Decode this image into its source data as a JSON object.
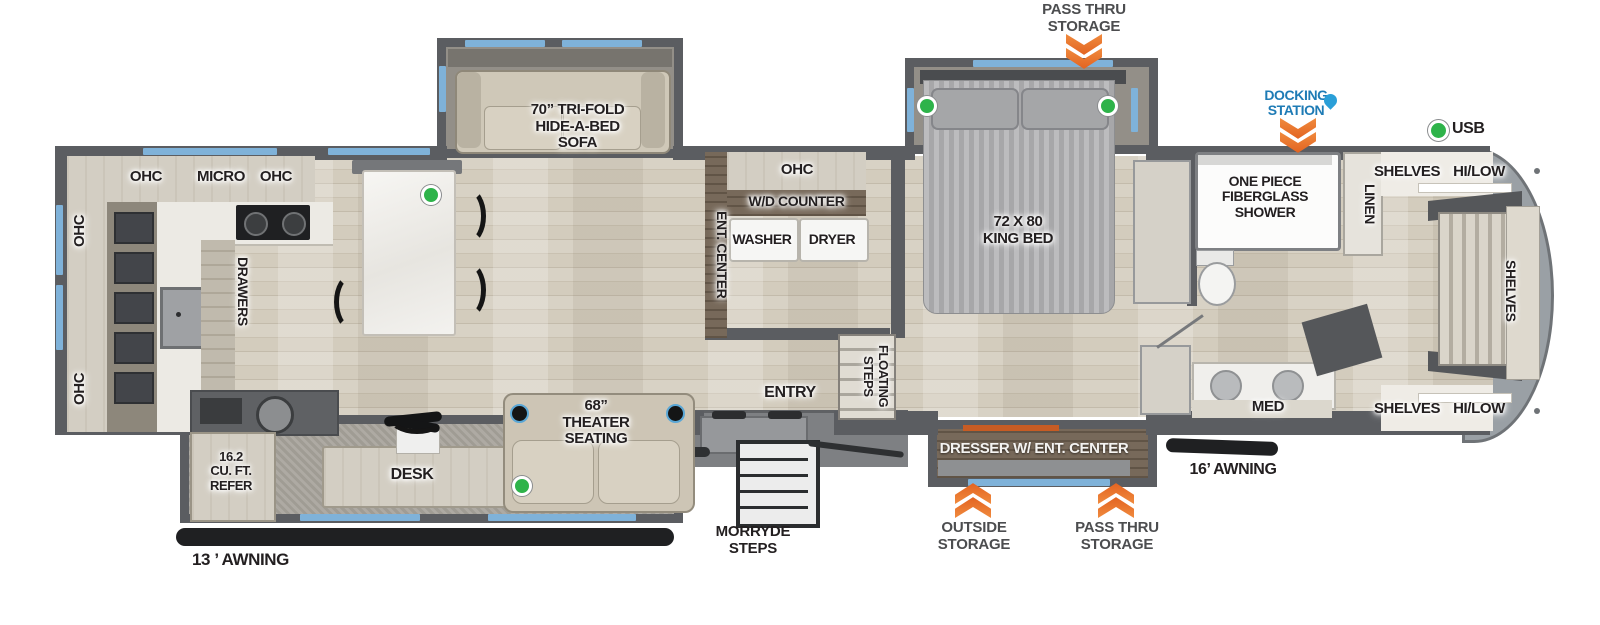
{
  "colors": {
    "wall": "#5b5d61",
    "window": "#7fb2d9",
    "chevron_orange": "#e8702a",
    "docking_blue": "#1e7bb5",
    "usb_green": "#2eb34a"
  },
  "callouts": {
    "pass_thru_storage_top": "PASS THRU\nSTORAGE",
    "docking_station": "DOCKING\nSTATION",
    "usb": "USB",
    "outside_storage": "OUTSIDE\nSTORAGE",
    "pass_thru_storage_bottom": "PASS THRU\nSTORAGE",
    "morryde_steps": "MORRYDE\nSTEPS",
    "awning_13": "13 ’ AWNING",
    "awning_16": "16’ AWNING"
  },
  "kitchen": {
    "ohc_top_left": "OHC",
    "micro": "MICRO",
    "ohc_top_right": "OHC",
    "ohc_wall_upper": "OHC",
    "ohc_wall_lower": "OHC",
    "drawers": "DRAWERS",
    "refer": "16.2\nCU. FT.\nREFER"
  },
  "living": {
    "sofa": "70” TRI-FOLD\nHIDE-A-BED\nSOFA",
    "theater_seating": "68”\nTHEATER\nSEATING",
    "desk": "DESK",
    "ent_center": "ENT. CENTER"
  },
  "laundry": {
    "ohc": "OHC",
    "wd_counter": "W/D COUNTER",
    "washer": "WASHER",
    "dryer": "DRYER"
  },
  "entry": {
    "entry": "ENTRY",
    "floating_steps": "FLOATING STEPS"
  },
  "bedroom": {
    "king_bed": "72 X 80\nKING BED",
    "dresser": "DRESSER W/ ENT. CENTER"
  },
  "bathroom": {
    "shower": "ONE PIECE\nFIBERGLASS\nSHOWER",
    "linen": "LINEN",
    "med": "MED"
  },
  "front_closet": {
    "shelves_top": "SHELVES",
    "hilow_top": "HI/LOW",
    "shelves_mid": "SHELVES",
    "shelves_bottom": "SHELVES",
    "hilow_bottom": "HI/LOW"
  }
}
